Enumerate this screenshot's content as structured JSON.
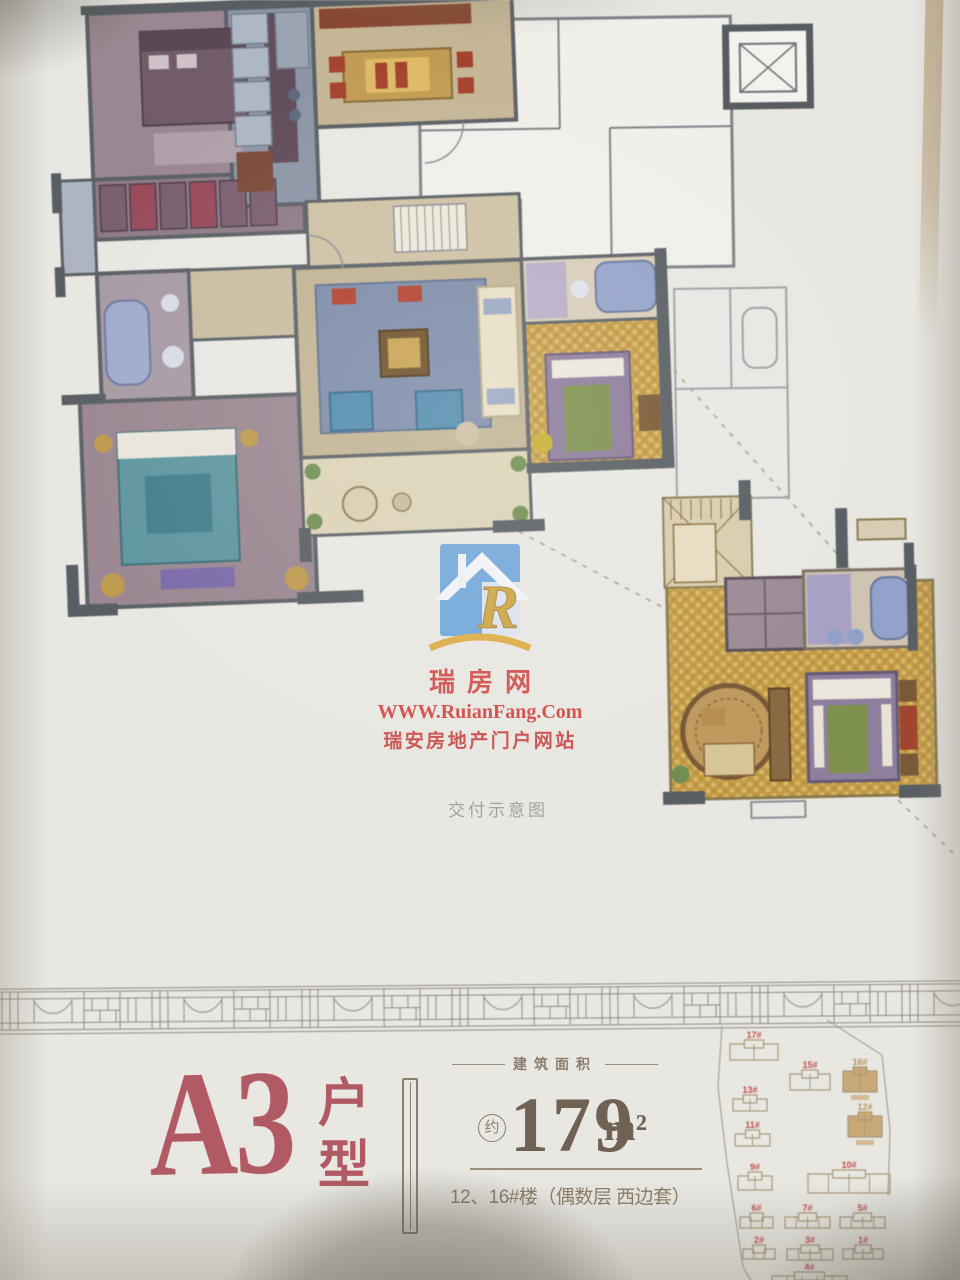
{
  "brand": {
    "logo_letter": "R",
    "name_cn": "瑞房网",
    "url": "WWW.RuianFang.Com",
    "tagline": "瑞安房地产门户网站"
  },
  "plan": {
    "caption": "交付示意图"
  },
  "unit": {
    "name": "A3",
    "type_chars": [
      "户",
      "型"
    ],
    "area_section_label": "建筑面积",
    "area_prefix": "约",
    "area_value": "179",
    "area_unit": "m²",
    "location_note": "12、16#楼（偶数层 西边套）"
  },
  "colors": {
    "accent_red": "#b25a64",
    "watermark_red": "#d14a46",
    "logo_blue": "#6ba3d9",
    "logo_gold": "#c9a23c",
    "area_text": "#6f6255",
    "muted_brown": "#8d7f6e"
  },
  "site_map": {
    "outline_color": "#a89878",
    "label_color": "#c05050",
    "highlight_fill": "#c9a877",
    "highlight_label_color": "#b89560",
    "buildings": [
      {
        "label": "17#",
        "x": 40,
        "y": 20,
        "w": 48,
        "h": 20,
        "lobes": 2,
        "hl": false
      },
      {
        "label": "15#",
        "x": 100,
        "y": 50,
        "w": 40,
        "h": 20,
        "lobes": 2,
        "hl": false
      },
      {
        "label": "16#",
        "x": 153,
        "y": 47,
        "w": 34,
        "h": 25,
        "lobes": 2,
        "hl": true
      },
      {
        "label": "13#",
        "x": 43,
        "y": 75,
        "w": 34,
        "h": 16,
        "lobes": 2,
        "hl": false
      },
      {
        "label": "12#",
        "x": 158,
        "y": 92,
        "w": 34,
        "h": 25,
        "lobes": 2,
        "hl": true
      },
      {
        "label": "11#",
        "x": 45,
        "y": 110,
        "w": 35,
        "h": 16,
        "lobes": 2,
        "hl": false
      },
      {
        "label": "9#",
        "x": 48,
        "y": 152,
        "w": 34,
        "h": 18,
        "lobes": 2,
        "hl": false
      },
      {
        "label": "10#",
        "x": 118,
        "y": 150,
        "w": 82,
        "h": 23,
        "lobes": 4,
        "hl": false
      },
      {
        "label": "6#",
        "x": 50,
        "y": 193,
        "w": 33,
        "h": 15,
        "lobes": 3,
        "hl": false
      },
      {
        "label": "7#",
        "x": 95,
        "y": 193,
        "w": 45,
        "h": 15,
        "lobes": 4,
        "hl": false
      },
      {
        "label": "5#",
        "x": 150,
        "y": 193,
        "w": 45,
        "h": 15,
        "lobes": 4,
        "hl": false
      },
      {
        "label": "2#",
        "x": 53,
        "y": 225,
        "w": 32,
        "h": 14,
        "lobes": 3,
        "hl": false
      },
      {
        "label": "3#",
        "x": 97,
        "y": 225,
        "w": 46,
        "h": 15,
        "lobes": 4,
        "hl": false
      },
      {
        "label": "1#",
        "x": 153,
        "y": 225,
        "w": 40,
        "h": 14,
        "lobes": 4,
        "hl": false
      },
      {
        "label": "4#",
        "x": 82,
        "y": 252,
        "w": 75,
        "h": 10,
        "lobes": 5,
        "hl": false
      }
    ]
  }
}
